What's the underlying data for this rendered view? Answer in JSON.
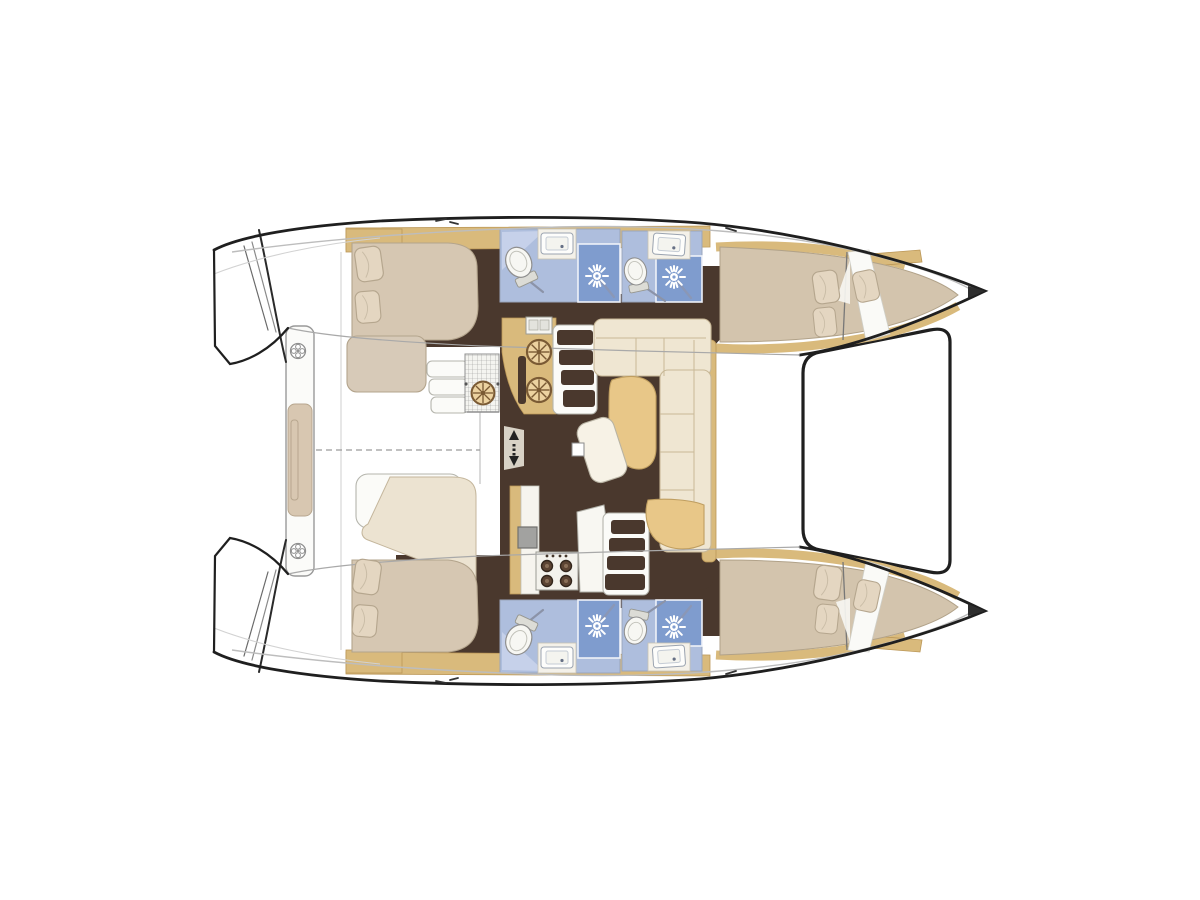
{
  "diagram": {
    "kind": "catamaran-interior-floor-plan-top-view",
    "orientation": {
      "bow": "right",
      "stern": "left"
    },
    "rooms": [
      {
        "name": "port-aft-cabin",
        "features": [
          "double-bed",
          "pillows",
          "bench-seat"
        ]
      },
      {
        "name": "port-aft-bathroom",
        "features": [
          "toilet",
          "washbasin",
          "shower"
        ]
      },
      {
        "name": "port-forward-bathroom",
        "features": [
          "toilet",
          "washbasin",
          "shower"
        ]
      },
      {
        "name": "port-forward-cabin",
        "features": [
          "double-bed",
          "pillows"
        ]
      },
      {
        "name": "port-forepeak-berth",
        "features": [
          "berth",
          "pillow"
        ]
      },
      {
        "name": "starboard-aft-cabin",
        "features": [
          "double-bed",
          "pillows",
          "bench-seat"
        ]
      },
      {
        "name": "starboard-aft-bathroom",
        "features": [
          "toilet",
          "washbasin",
          "shower"
        ]
      },
      {
        "name": "starboard-forward-bathroom",
        "features": [
          "toilet",
          "washbasin",
          "shower"
        ]
      },
      {
        "name": "starboard-forward-cabin",
        "features": [
          "double-bed",
          "pillows"
        ]
      },
      {
        "name": "starboard-forepeak-berth",
        "features": [
          "berth",
          "pillow"
        ]
      },
      {
        "name": "saloon",
        "features": [
          "u-shaped-sofa",
          "table",
          "ottoman",
          "mast-post"
        ]
      },
      {
        "name": "galley",
        "features": [
          "double-round-sinks",
          "worktop",
          "four-burner-stove",
          "appliance"
        ]
      },
      {
        "name": "cockpit",
        "features": [
          "aft-bench",
          "cushion",
          "steps",
          "grill-module",
          "deck-fittings",
          "centerline"
        ]
      },
      {
        "name": "transom-steps-port"
      },
      {
        "name": "transom-steps-starboard"
      },
      {
        "name": "trampoline"
      }
    ]
  },
  "colors": {
    "bg": "#ffffff",
    "outline": "#1f1f1f",
    "floor": "#4a382d",
    "wood": "#d9ba7c",
    "wood_line": "#bb9757",
    "bed": "#d6c7b2",
    "pillow": "#e4d6c1",
    "sofa": "#efe6d2",
    "table": "#e8c788",
    "bath": "#aebedd",
    "shower": "#7f9cce",
    "toilet": "#f7f7f3",
    "appliance": "#a2a2a0",
    "burner": "#5c4433"
  },
  "fixtures": {
    "toilets": [
      {
        "x": 520,
        "y": 265,
        "rot": -25,
        "s": 1
      },
      {
        "x": 636,
        "y": 274,
        "rot": -12,
        "s": 0.88
      },
      {
        "x": 520,
        "y": 637,
        "rot": 205,
        "s": 1
      },
      {
        "x": 636,
        "y": 628,
        "rot": 192,
        "s": 0.88
      }
    ],
    "showers": [
      {
        "x": 597,
        "y": 276,
        "flip": 1
      },
      {
        "x": 674,
        "y": 277,
        "flip": 1
      },
      {
        "x": 597,
        "y": 626,
        "flip": -1
      },
      {
        "x": 674,
        "y": 627,
        "flip": -1
      }
    ],
    "bath_sinks": [
      {
        "x": 557,
        "y": 244,
        "rot": 0
      },
      {
        "x": 669,
        "y": 245,
        "rot": 4
      },
      {
        "x": 557,
        "y": 658,
        "rot": 0
      },
      {
        "x": 669,
        "y": 657,
        "rot": -4
      }
    ],
    "pillows": [
      {
        "x": 369,
        "y": 264,
        "rot": -8,
        "s": 1
      },
      {
        "x": 368,
        "y": 307,
        "rot": -5,
        "s": 0.93
      },
      {
        "x": 367,
        "y": 577,
        "rot": 8,
        "s": 1
      },
      {
        "x": 365,
        "y": 621,
        "rot": 5,
        "s": 0.93
      },
      {
        "x": 826,
        "y": 287,
        "rot": -8,
        "s": 0.95
      },
      {
        "x": 825,
        "y": 322,
        "rot": -6,
        "s": 0.85
      },
      {
        "x": 866,
        "y": 286,
        "rot": -12,
        "s": 0.9
      },
      {
        "x": 828,
        "y": 583,
        "rot": 8,
        "s": 1
      },
      {
        "x": 827,
        "y": 619,
        "rot": 6,
        "s": 0.85
      },
      {
        "x": 867,
        "y": 596,
        "rot": 12,
        "s": 0.9
      }
    ],
    "wheels": [
      {
        "x": 539,
        "y": 352,
        "s": 1,
        "name": "galley-sink-round"
      },
      {
        "x": 539,
        "y": 390,
        "s": 1,
        "name": "galley-sink-round"
      },
      {
        "x": 483,
        "y": 393,
        "s": 0.95,
        "name": "cockpit-grill-burner"
      }
    ],
    "deck_fittings": [
      {
        "x": 298,
        "y": 351
      },
      {
        "x": 298,
        "y": 551
      }
    ],
    "burners": [
      {
        "x": 547,
        "y": 566
      },
      {
        "x": 566,
        "y": 566
      },
      {
        "x": 547,
        "y": 581
      },
      {
        "x": 566,
        "y": 581
      }
    ],
    "stove_knobs": [
      {
        "x": 547,
        "y": 556
      },
      {
        "x": 553,
        "y": 556
      },
      {
        "x": 560,
        "y": 556
      },
      {
        "x": 566,
        "y": 556
      }
    ]
  }
}
